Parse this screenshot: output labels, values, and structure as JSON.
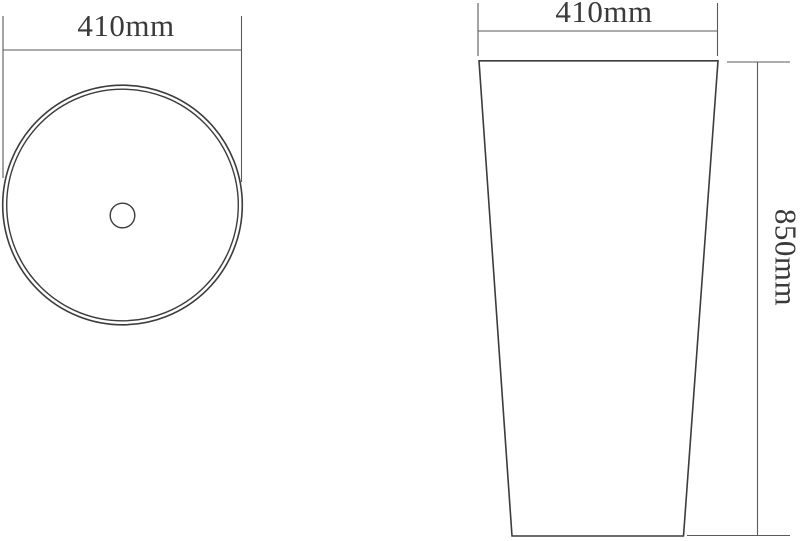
{
  "drawing": {
    "type": "technical-dimension-drawing",
    "subject": "pedestal-basin",
    "colors": {
      "outline": "#3c3c3c",
      "dimension": "#5a5a5a",
      "text": "#3a3a3a",
      "background": "#ffffff"
    },
    "views": {
      "top_view": {
        "name": "basin top view",
        "width_dimension": {
          "label": "410mm"
        }
      },
      "front_view": {
        "name": "pedestal front view",
        "width_dimension": {
          "label": "410mm"
        },
        "height_dimension": {
          "label": "850mm"
        }
      }
    }
  }
}
